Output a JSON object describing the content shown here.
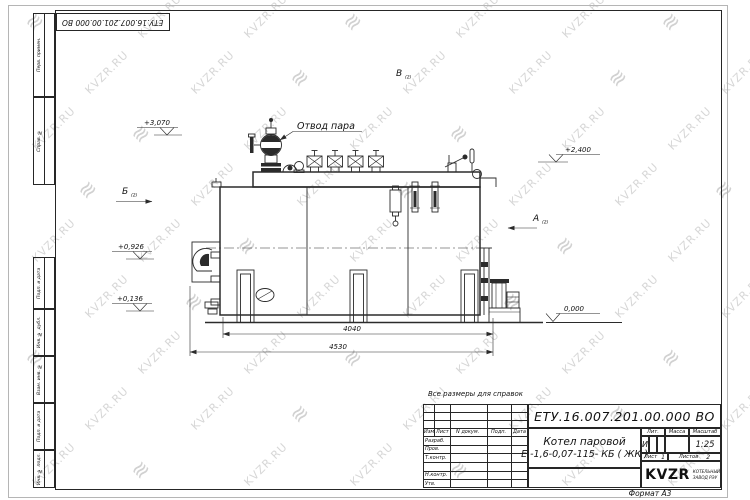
{
  "page": {
    "format_label": "Формат А3"
  },
  "colors": {
    "line": "#2b2b2b",
    "watermark": "#c9c9c9"
  },
  "watermark": {
    "text": "KVZR.RU",
    "logo_glyph": "≋"
  },
  "top_stamp": {
    "designation": "ЕТУ.16.007.201.00.000  ВО"
  },
  "left_margin_stamps": [
    "Перв. примен.",
    "Справ. №",
    "Подп. и дата",
    "Инв. № дубл.",
    "Взам. инв. №",
    "Подп. и дата",
    "Инв. № подл."
  ],
  "drawing": {
    "note": "Все размеры для справок",
    "labels": {
      "steam_outlet": "Отвод пара"
    },
    "views": [
      {
        "label": "Б",
        "sub": "(2)"
      },
      {
        "label": "В",
        "sub": "(2)"
      },
      {
        "label": "А",
        "sub": "(2)"
      }
    ],
    "elevations": [
      "+3,070",
      "+2,400",
      "+0,926",
      "+0,136",
      "0,000"
    ],
    "dimensions": [
      "4040",
      "4530"
    ]
  },
  "title_block": {
    "designation": "ЕТУ.16.007.201.00.000  ВО",
    "name_line1": "Котел паровой",
    "name_line2": "Е -1,6-0,07-115- КБ ( ЖК )",
    "header_cells": [
      "Изм",
      "Лист",
      "N докум.",
      "Подп.",
      "Дата"
    ],
    "row_labels": [
      "Разраб.",
      "Пров.",
      "Т.контр.",
      "Н.контр.",
      "Утв."
    ],
    "lit_header": "Лит.",
    "mass_header": "Масса",
    "scale_header": "Масштаб",
    "lit_value": "И",
    "scale_value": "1:25",
    "sheet_label": "Лист",
    "sheet_value": "1",
    "sheets_label": "Листов",
    "sheets_value": "2",
    "company": {
      "logo_text": "KVZR",
      "sub_line1": "КОТЕЛЬНЫЙ",
      "sub_line2": "ЗАВОД РЭУ"
    }
  }
}
